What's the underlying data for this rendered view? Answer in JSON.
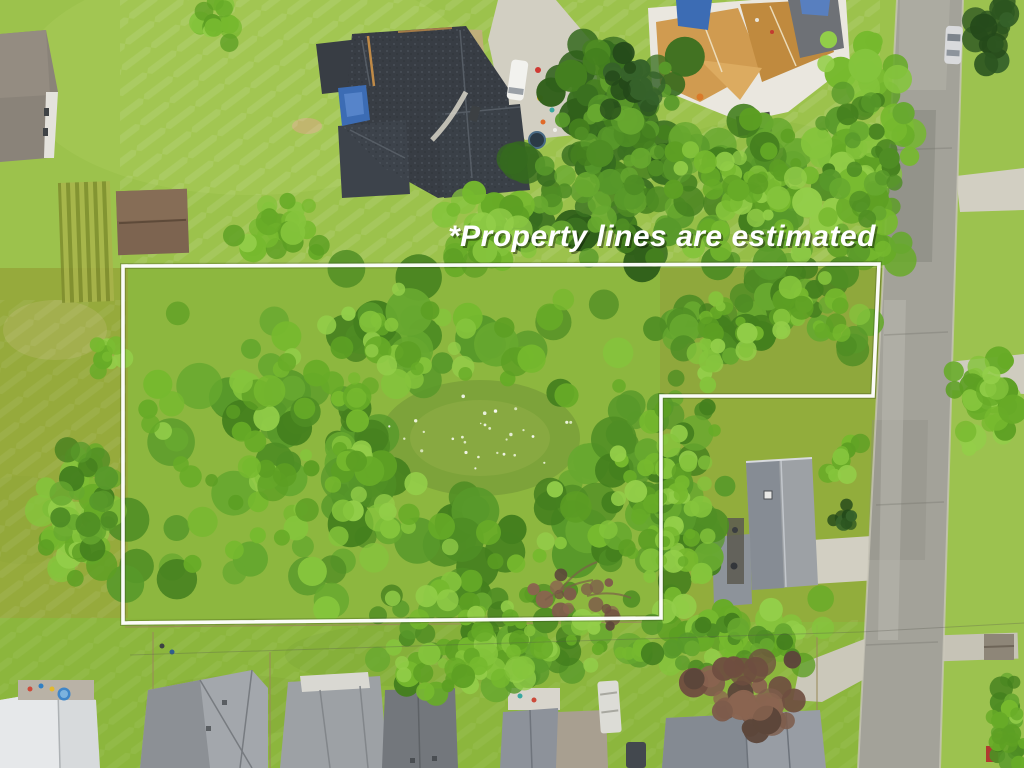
{
  "overlay": {
    "disclaimer_text": "*Property lines are estimated",
    "text_color": "#ffffff",
    "boundary_color": "#ffffff",
    "boundary_points": "123,266 879,264 873,396 661,396 661,618 123,623"
  },
  "palette": {
    "lawn_base": "#8db73f",
    "lawn_top": "#9cc24c",
    "lawn_olive": "#97a93c",
    "lawn_bottom": "#8cb63d",
    "road_asphalt": "#a3a299",
    "concrete": "#d2cfc2",
    "canopy_bright": "#7cbd35",
    "canopy_dark": "#3a7020",
    "roof_dark_mansion": "#383d44",
    "roof_gray": "#9da1a5",
    "construction_roof_wood": "#d09b50",
    "tarp_blue": "#3c6cb4",
    "pool_blue": "#3f86c8",
    "shed_brown": "#7d6450",
    "van_color": "#f2f2ee",
    "car_color": "#d9dadc"
  }
}
